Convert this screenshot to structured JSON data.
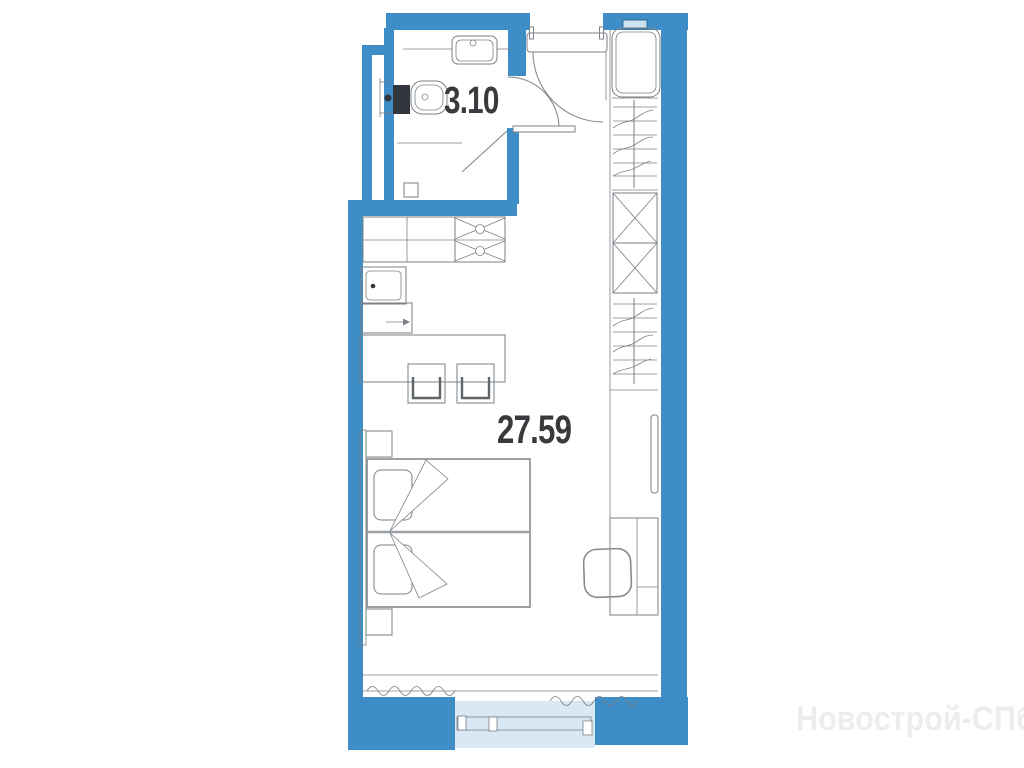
{
  "plan": {
    "title": "studio-apartment-floor-plan",
    "bathroom": {
      "area_label": "3.10"
    },
    "main_room": {
      "area_label": "27.59"
    },
    "watermark": "Новострой-СПб",
    "colors": {
      "wall": "#3e8dc6",
      "glazing": "#d9e8f4",
      "line": "#7b8187",
      "label_text": "#3a3a3e",
      "watermark_text": "#ededed"
    },
    "items": [
      "bathroom-sink",
      "toilet",
      "shower-screen",
      "floor-drain",
      "entrance-door",
      "bathroom-door",
      "kitchen-counter",
      "kitchen-sink",
      "hob",
      "appliance-arrow",
      "dining-table",
      "stool",
      "double-bed",
      "pillow",
      "nightstand",
      "headboard",
      "washing-machine",
      "wardrobe-hanging-section",
      "wardrobe-cross-shelves",
      "tv",
      "desk",
      "chair",
      "window",
      "curtain"
    ]
  }
}
